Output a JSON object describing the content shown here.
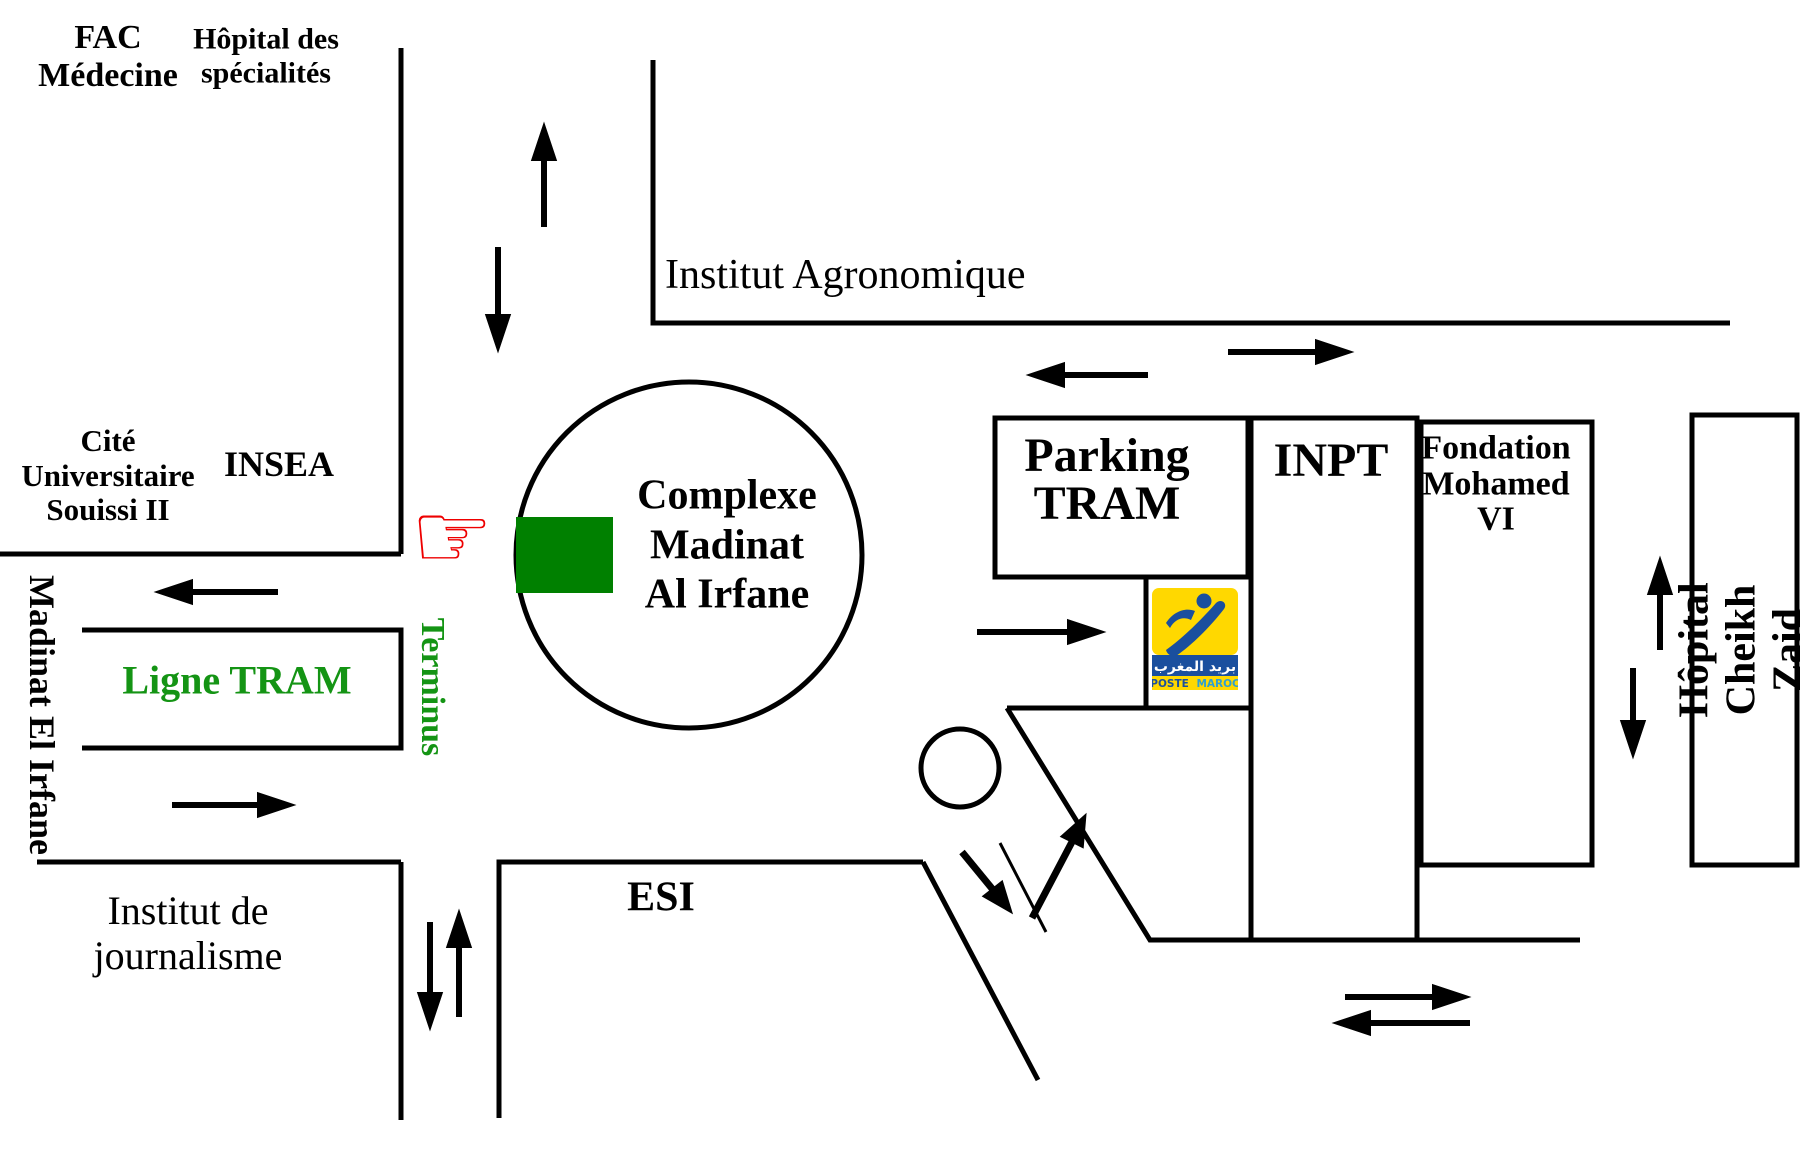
{
  "map": {
    "title_area": "Madinat Al Irfane schematic map",
    "labels": {
      "fac_medecine": "FAC\nMédecine",
      "hopital_specialites": "Hôpital des\nspécialités",
      "cite_universitaire": "Cité\nUniversitaire\nSouissi II",
      "insea": "INSEA",
      "institut_agronomique": "Institut Agronomique",
      "complexe_madinat": "Complexe\nMadinat\nAl Irfane",
      "parking_tram": "Parking\nTRAM",
      "inpt": "INPT",
      "fondation_mohamed_vi": "Fondation\nMohamed\nVI",
      "hopital_cheikh_zaid": "Hôpital Cheikh Zaid",
      "madinat_el_irfane": "Madinat El Irfane",
      "terminus": "Terminus",
      "ligne_tram": "Ligne TRAM",
      "esi": "ESI",
      "institut_journalisme": "Institut de\njournalisme"
    },
    "logo": {
      "name": "Poste Maroc",
      "arabic": "بريد المغرب",
      "poste": "POSTE",
      "maroc": "MAROC"
    },
    "icons": {
      "pointing_hand": "☞"
    },
    "colors": {
      "road": "#000000",
      "tram_stop_green": "#008000",
      "green_text": "#149414",
      "hand_red": "#ee0000",
      "logo_yellow": "#ffd800",
      "logo_blue": "#1a4f9e",
      "logo_light_blue": "#2f9fd0"
    }
  }
}
